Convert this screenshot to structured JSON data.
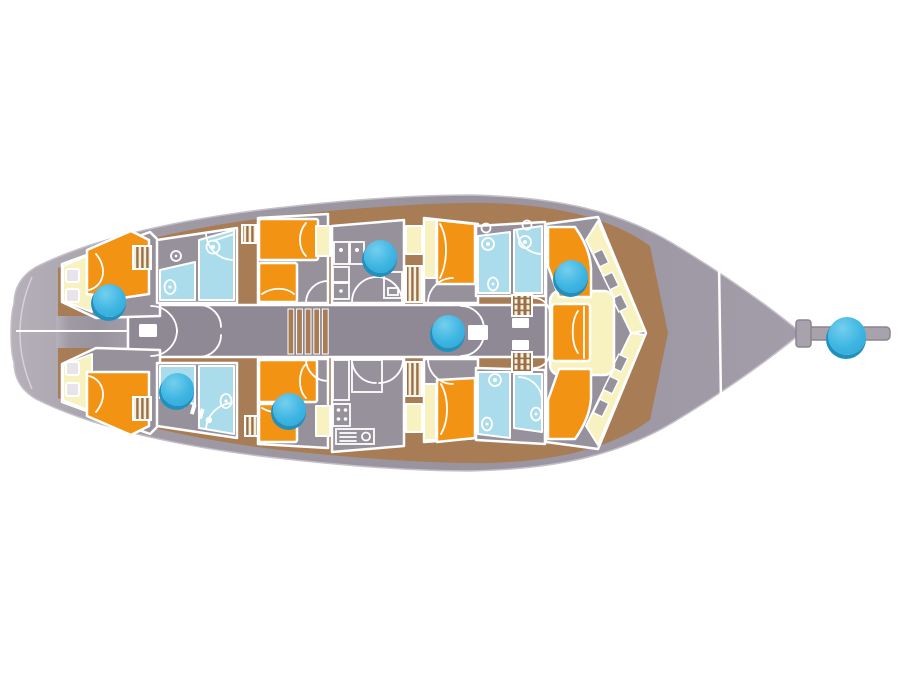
{
  "colors": {
    "background": "#ffffff",
    "hull": "#9d97a2",
    "hull_light": "#b6b0b9",
    "room_floor": "#97919c",
    "corridor": "#8f8995",
    "walkway_brown": "#a87c55",
    "bed_orange": "#f39313",
    "seat_cream": "#f7f2c0",
    "bath_blue": "#abdcec",
    "wall_white": "#ffffff",
    "marker_fill": "#3db5e2",
    "marker_shadow": "#2090bf",
    "bowsprit": "#a8a2ac"
  },
  "hotspots": [
    {
      "id": "aft-port-cabin",
      "x": 109,
      "y": 300,
      "d": 33
    },
    {
      "id": "aft-starboard-bathroom",
      "x": 177,
      "y": 389,
      "d": 33
    },
    {
      "id": "galley-upper",
      "x": 380,
      "y": 256,
      "d": 33
    },
    {
      "id": "mid-starboard-cabin",
      "x": 289,
      "y": 409,
      "d": 33
    },
    {
      "id": "salon-corridor",
      "x": 448,
      "y": 331,
      "d": 33
    },
    {
      "id": "bow-port-seat",
      "x": 571,
      "y": 276,
      "d": 33
    },
    {
      "id": "bowsprit",
      "x": 847,
      "y": 336,
      "d": 38
    }
  ]
}
